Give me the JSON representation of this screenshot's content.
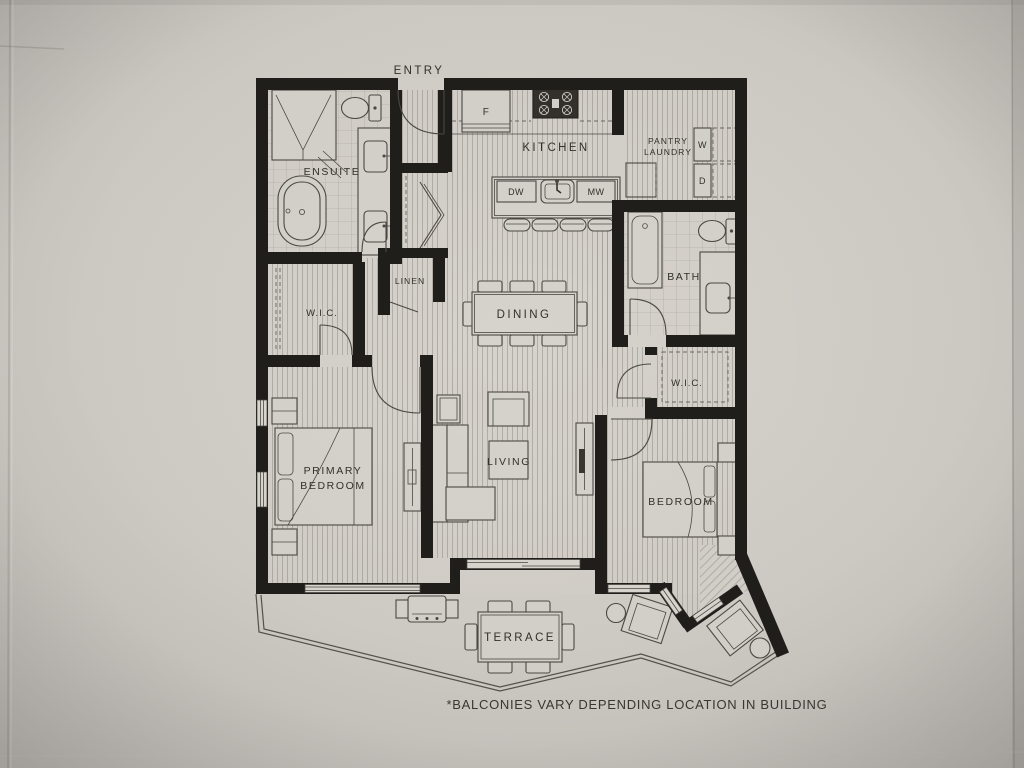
{
  "document": {
    "type": "floor-plan-photo",
    "note": "*BALCONIES VARY DEPENDING LOCATION IN BUILDING"
  },
  "palette": {
    "paper": "#d3cfc9",
    "paper_edge": "#bdb9b4",
    "wall": "#201e1b",
    "line": "#4c4944",
    "text": "#33312d"
  },
  "rooms": {
    "entry": {
      "label": "ENTRY"
    },
    "kitchen": {
      "label": "KITCHEN"
    },
    "pantry_laundry": {
      "line1": "PANTRY",
      "line2": "LAUNDRY"
    },
    "ensuite": {
      "label": "ENSUITE"
    },
    "linen": {
      "label": "LINEN"
    },
    "bath": {
      "label": "BATH"
    },
    "wic_primary": {
      "label": "W.I.C."
    },
    "wic_bedroom": {
      "label": "W.I.C."
    },
    "dining": {
      "label": "DINING"
    },
    "primary_bedroom": {
      "line1": "PRIMARY",
      "line2": "BEDROOM"
    },
    "living": {
      "label": "LIVING"
    },
    "bedroom": {
      "label": "BEDROOM"
    },
    "terrace": {
      "label": "TERRACE"
    }
  },
  "appliances": {
    "fridge": "F",
    "dishwasher": "DW",
    "microwave": "MW",
    "washer": "W",
    "dryer": "D"
  }
}
